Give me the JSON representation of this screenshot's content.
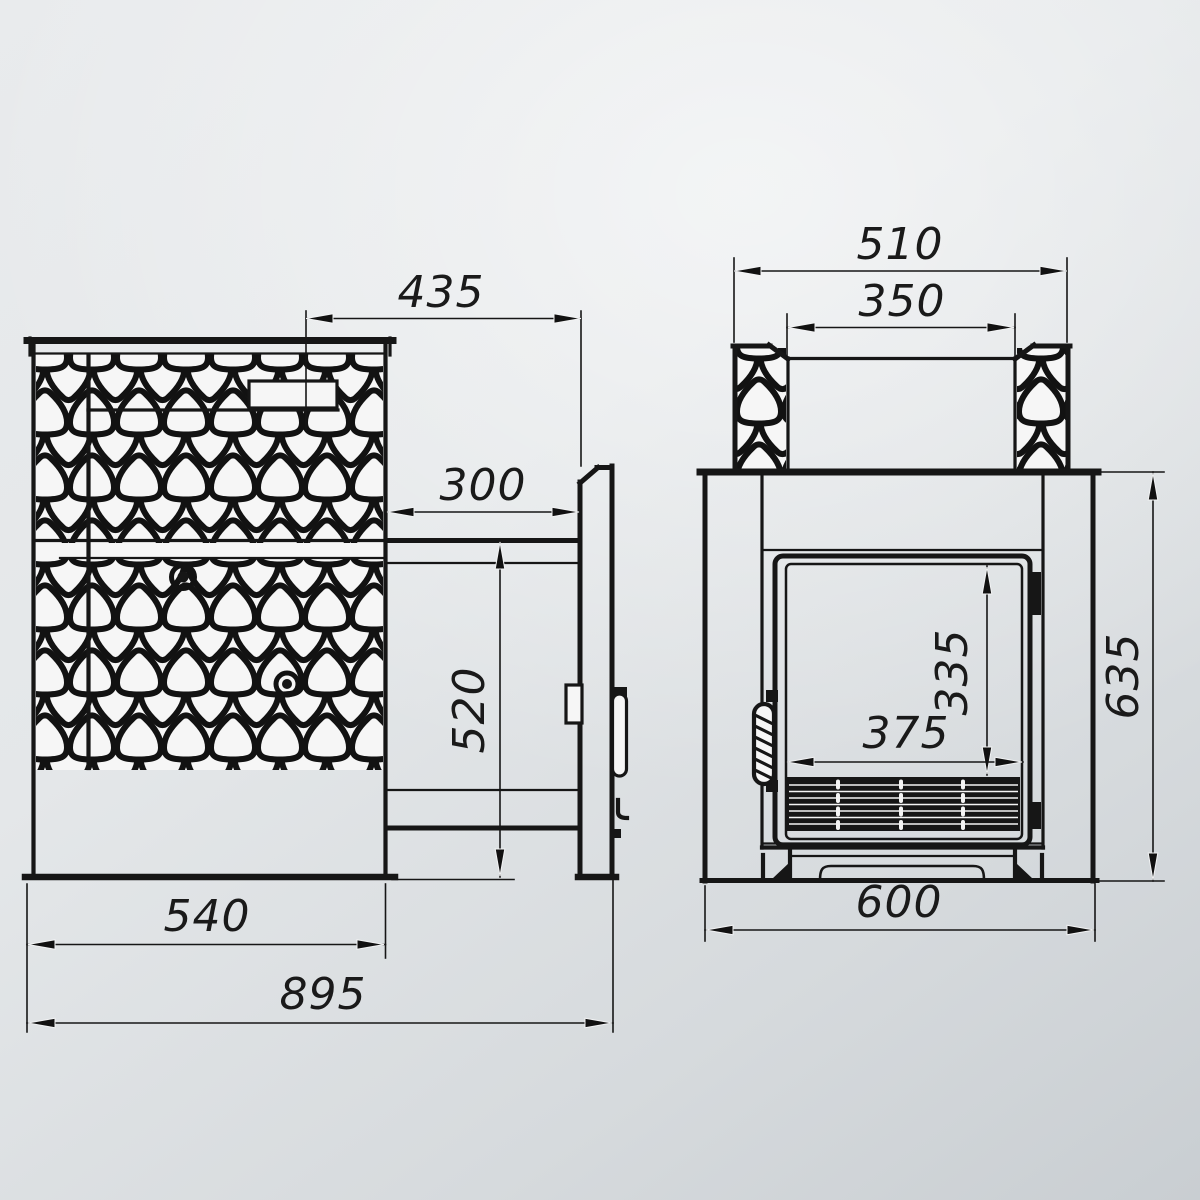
{
  "drawing": {
    "kind": "technical-dimension-drawing",
    "subject": "sauna stove, two orthographic views with millimetre dimensions",
    "views": {
      "side": {
        "name": "side view",
        "dims": {
          "top_offset": "435",
          "tunnel_length": "300",
          "tunnel_height": "520",
          "body_width": "540",
          "overall_depth": "895"
        }
      },
      "front": {
        "name": "front view",
        "dims": {
          "collar_width": "510",
          "collar_opening": "350",
          "door_height": "335",
          "door_width": "375",
          "body_height": "635",
          "body_width": "600"
        }
      }
    },
    "colors": {
      "line": "#161616",
      "background_light": "#e9ebed",
      "background_dark": "#c9ced2",
      "fill_white": "#f6f6f6"
    }
  }
}
